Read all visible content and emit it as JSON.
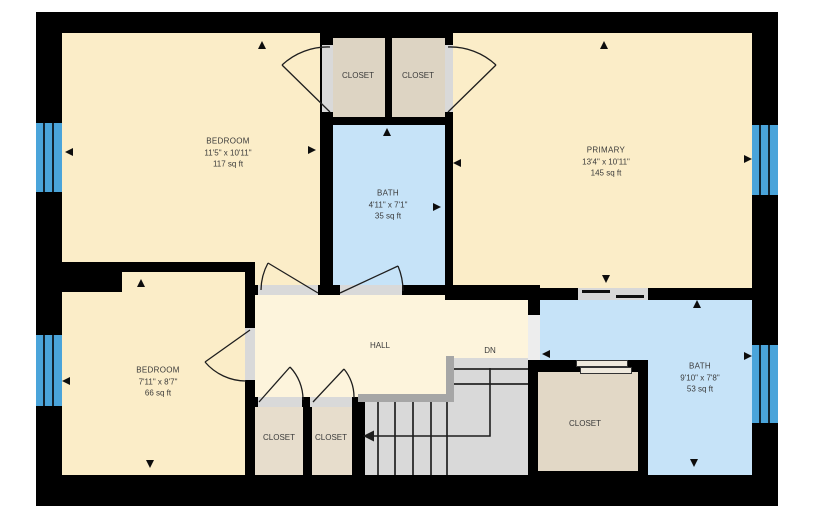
{
  "floorplan": {
    "rooms": [
      {
        "id": "bedroom-1",
        "name": "BEDROOM",
        "dimensions": "11'5\" x 10'11\"",
        "area": "117 sq ft"
      },
      {
        "id": "primary",
        "name": "PRIMARY",
        "dimensions": "13'4\" x 10'11\"",
        "area": "145 sq ft"
      },
      {
        "id": "bath-1",
        "name": "BATH",
        "dimensions": "4'11\" x 7'1\"",
        "area": "35 sq ft"
      },
      {
        "id": "bedroom-2",
        "name": "BEDROOM",
        "dimensions": "7'11\" x 8'7\"",
        "area": "66 sq ft"
      },
      {
        "id": "bath-2",
        "name": "BATH",
        "dimensions": "9'10\" x 7'8\"",
        "area": "53 sq ft"
      }
    ],
    "closets": [
      "CLOSET",
      "CLOSET",
      "CLOSET",
      "CLOSET",
      "CLOSET"
    ],
    "hall_label": "HALL",
    "stairs_down_label": "DN",
    "colors": {
      "wall": "#000000",
      "room": "#fbedc8",
      "hall": "#fdf4dc",
      "bath": "#c6e3f8",
      "closet": "#ddd4c3",
      "closet_light": "#e7ddcc",
      "closet_big": "#e2d8c6",
      "window": "#4aa4da",
      "stairs": "#d9d9d9",
      "railing": "#a6a6a6",
      "threshold": "#d9d9d9"
    }
  }
}
